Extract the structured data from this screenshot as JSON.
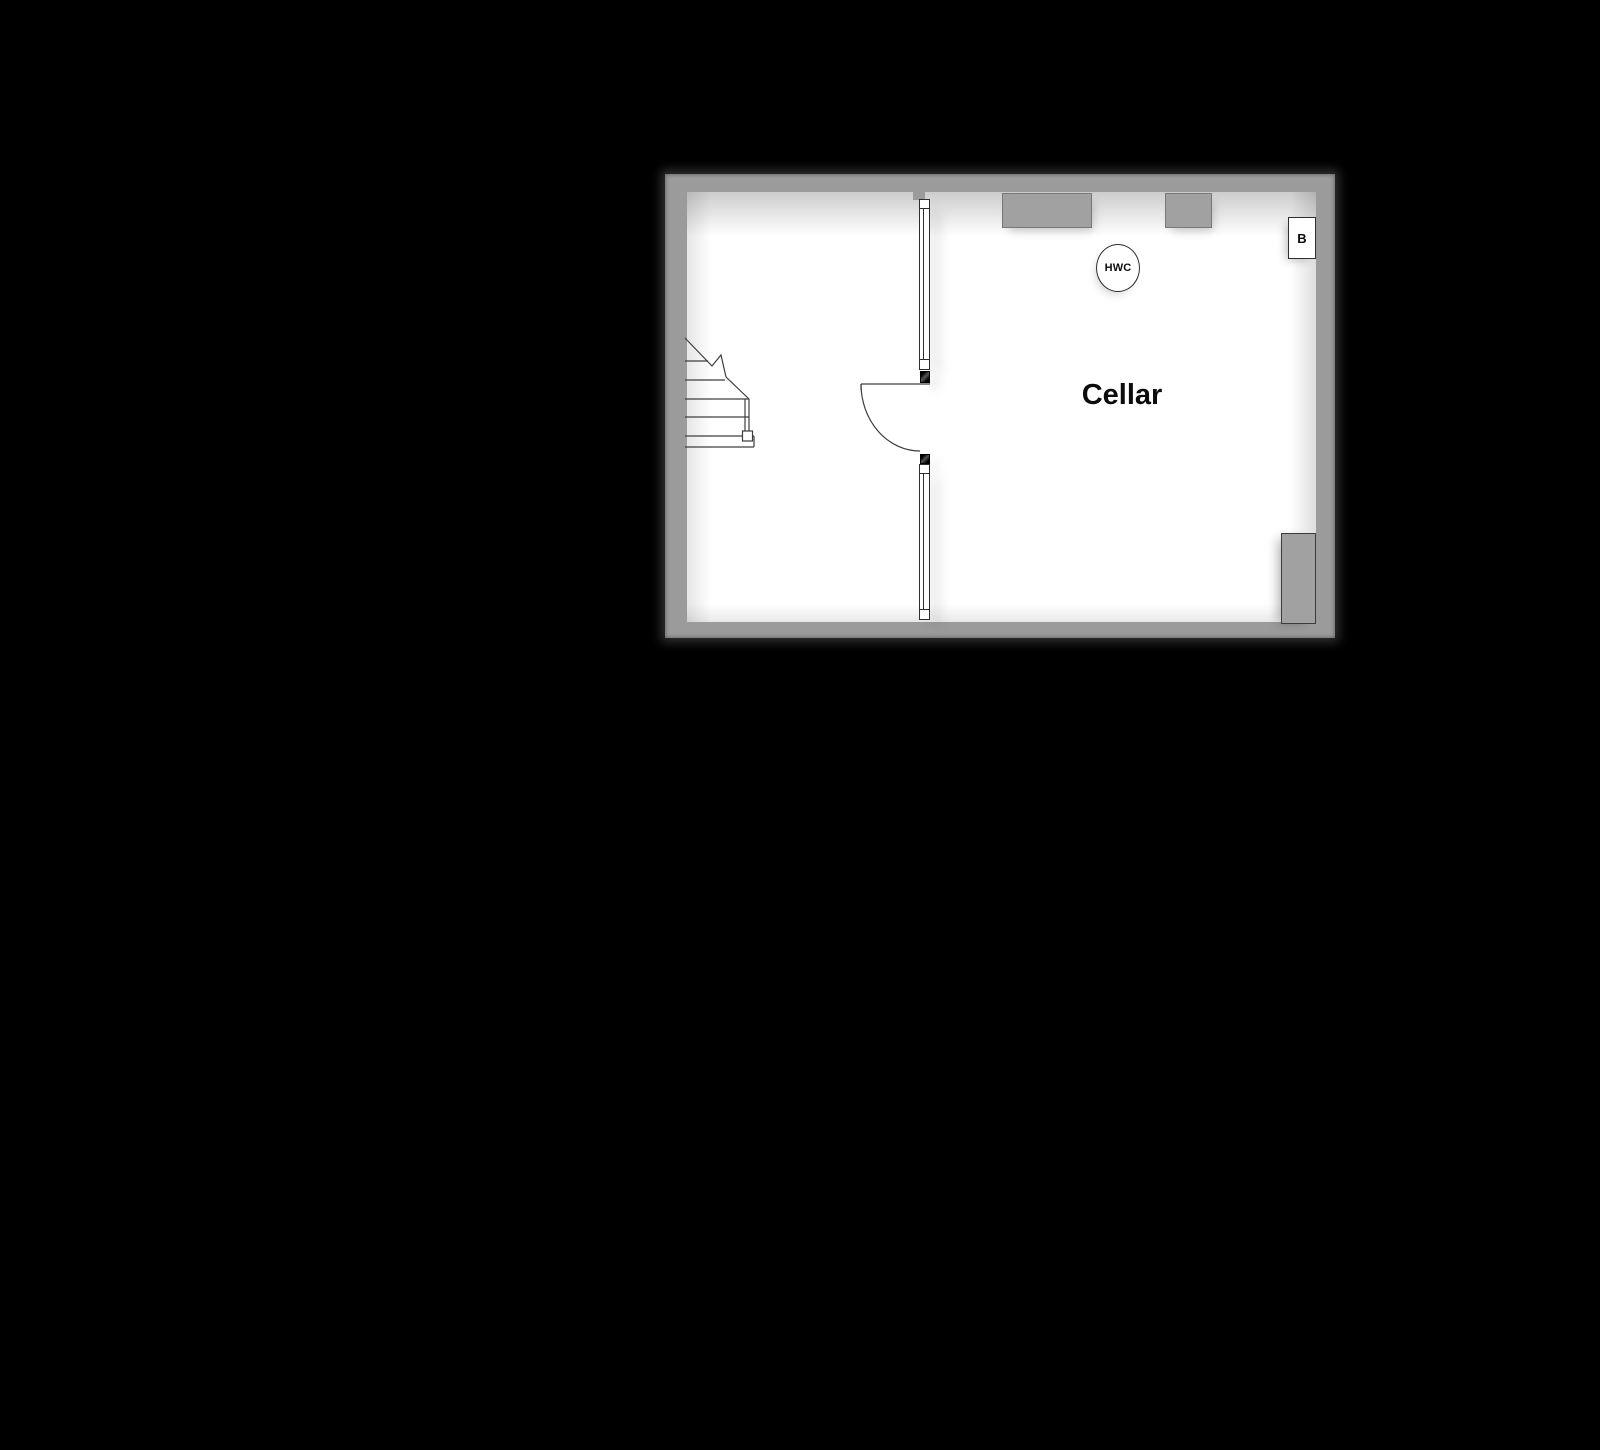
{
  "canvas": {
    "background": "#000000"
  },
  "floorplan": {
    "room": {
      "label": "Cellar"
    },
    "annotations": {
      "hot_water_cylinder": "HWC",
      "boiler": "B"
    },
    "colors": {
      "wall": "#9b9b9b",
      "fixture": "#a1a1a1",
      "interior": "#ffffff",
      "outline": "#2e2e2e",
      "background": "#000000"
    }
  }
}
